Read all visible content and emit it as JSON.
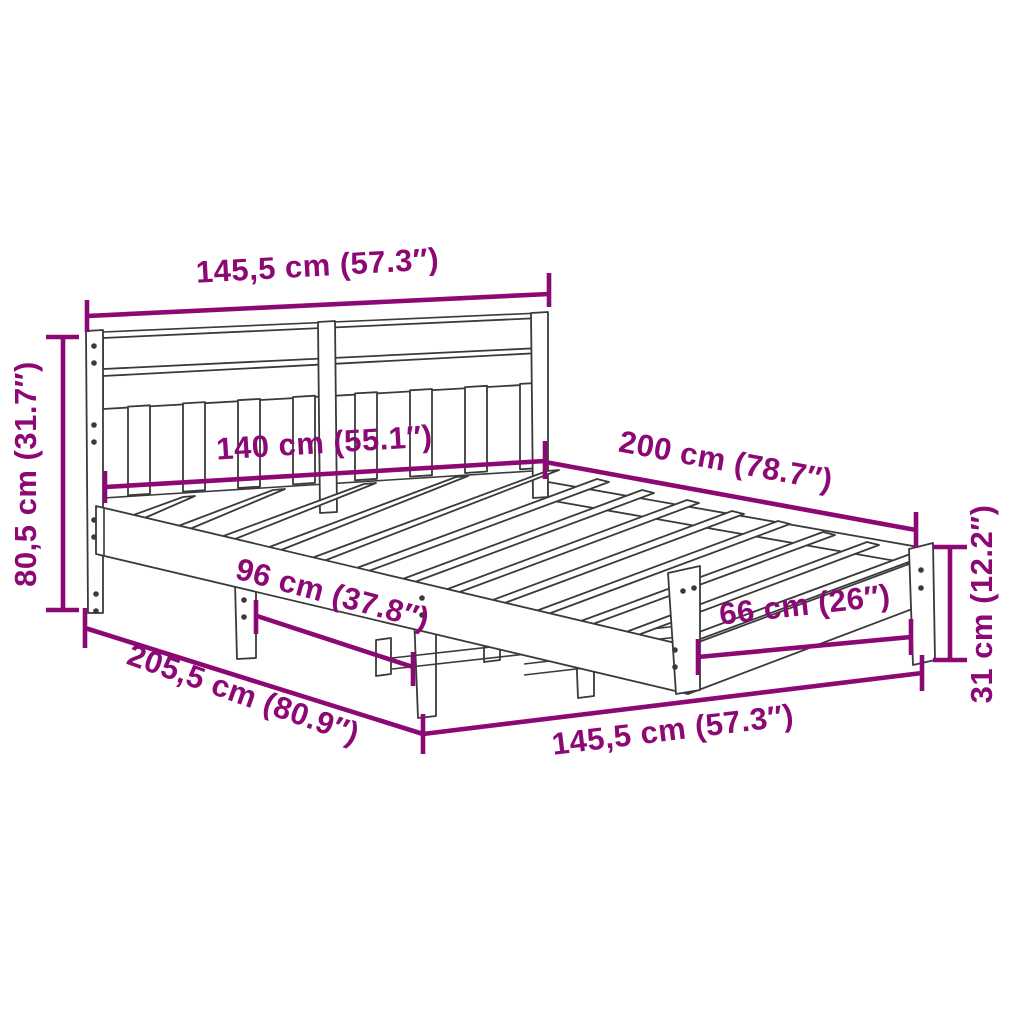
{
  "diagram": {
    "kind": "furniture-dimension-diagram",
    "subject": "bed-frame-with-headboard",
    "colors": {
      "dimension_accent": "#8C0874",
      "outline": "#3A3A3A",
      "background": "#FFFFFF"
    },
    "dimensions": {
      "headboard_width_top": "145,5 cm (57.3″)",
      "headboard_height": "80,5 cm (31.7″)",
      "mattress_width": "140 cm (55.1″)",
      "mattress_length": "200 cm (78.7″)",
      "base_height": "31 cm (12.2″)",
      "side_leg_spacing": "96 cm (37.8″)",
      "foot_leg_spacing": "66 cm (26″)",
      "total_length": "205,5 cm (80.9″)",
      "frame_width_bottom": "145,5 cm (57.3″)"
    }
  }
}
